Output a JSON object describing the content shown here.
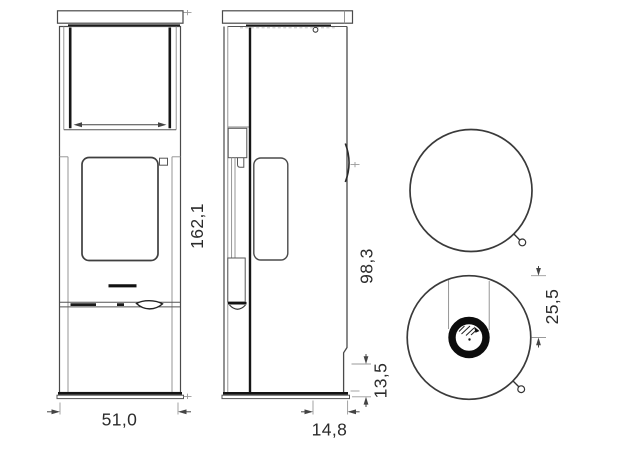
{
  "drawing": {
    "title": "stove technical drawing, three orthographic views",
    "dimensions": {
      "front_height": "162,1",
      "front_width": "51,0",
      "handle_height": "98,3",
      "base_height": "13,5",
      "flue_depth": "14,8",
      "flue_offset": "25,5"
    },
    "views": {
      "front": "front elevation with door glass and handle",
      "side": "side elevation with side glass, handle arc and rear chamfer",
      "top_plain": "top view with door handle knob",
      "top_flue": "top view with flue collar and door handle knob"
    },
    "colors": {
      "line": "#4a4a4a",
      "dark_line": "#161616",
      "dimension_text": "#2b2b2b",
      "background": "#ffffff"
    }
  }
}
